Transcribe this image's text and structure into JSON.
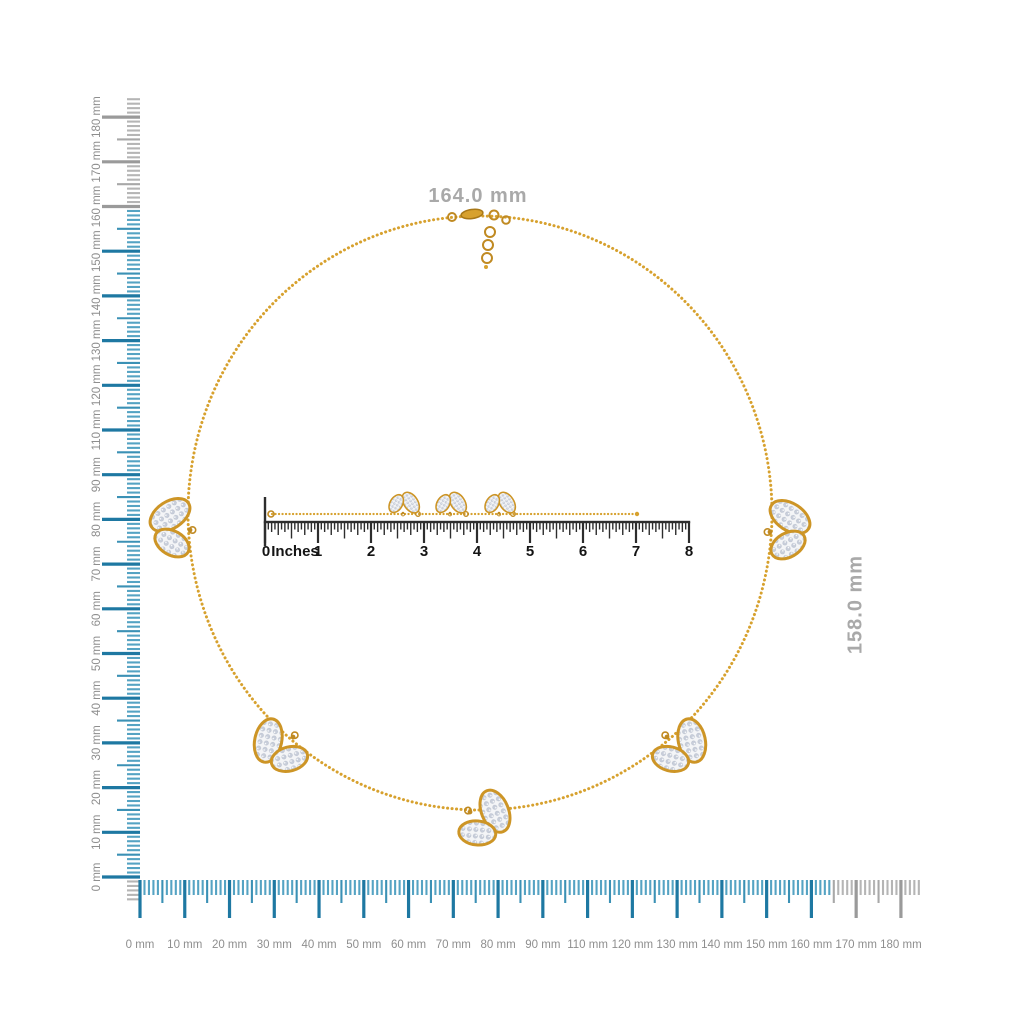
{
  "figure": {
    "kind": "product-measurement-diagram",
    "dimension_labels": {
      "width": "164.0 mm",
      "height": "158.0 mm"
    }
  },
  "left_ruler": {
    "unit": "mm",
    "orientation": "vertical",
    "labels_top_to_bottom": [
      "180 mm",
      "170 mm",
      "160 mm",
      "150 mm",
      "140 mm",
      "130 mm",
      "120 mm",
      "110 mm",
      "90 mm",
      "80 mm",
      "70 mm",
      "60 mm",
      "50 mm",
      "40 mm",
      "30 mm",
      "20 mm",
      "10 mm",
      "0 mm"
    ],
    "measured_extent_mm": 158
  },
  "bottom_ruler": {
    "unit": "mm",
    "orientation": "horizontal",
    "labels_left_to_right": [
      "0 mm",
      "10 mm",
      "20 mm",
      "30 mm",
      "40 mm",
      "50 mm",
      "60 mm",
      "70 mm",
      "80 mm",
      "90 mm",
      "110 mm",
      "120 mm",
      "130 mm",
      "140 mm",
      "150 mm",
      "160 mm",
      "170 mm",
      "180 mm"
    ],
    "measured_extent_mm": 164
  },
  "inch_ruler": {
    "zero_label": "0",
    "unit_label": "Inches",
    "number_labels": [
      "1",
      "2",
      "3",
      "4",
      "5",
      "6",
      "7",
      "8"
    ],
    "subdivisions_per_inch": 16
  },
  "product": {
    "pendant_count": 5,
    "charm_count_on_straight_chain": 3
  },
  "colors": {
    "tick_blue_major": "#1e78a2",
    "tick_blue_medium": "#3b91b5",
    "tick_blue_minor": "#55a3c3",
    "tick_gray_major": "#9a9a9a",
    "tick_gray_medium": "#a8a8a8",
    "tick_gray_minor": "#b5b5b5",
    "ruler_label_gray": "#8e8e8e",
    "dimension_label_gray": "#a9a9a9",
    "inch_ruler_dark": "#2d2d2d",
    "inch_label_black": "#141414",
    "gold": "#d7a12e",
    "gold_dark": "#b5831e",
    "pave_diamond": "#c8ceda"
  }
}
